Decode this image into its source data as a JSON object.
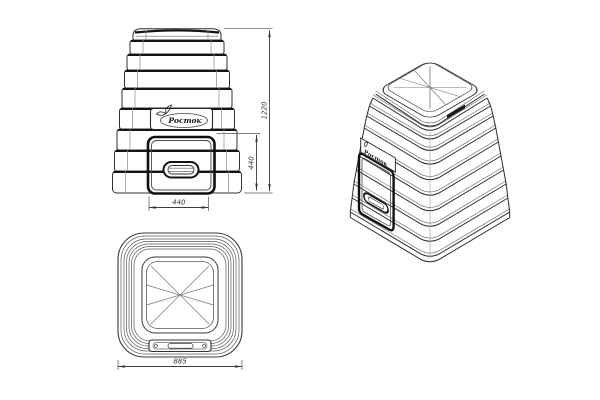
{
  "brand": "Росток",
  "dimensions": {
    "overall_height": "1220",
    "door_height": "440",
    "door_width": "440",
    "base_width": "885"
  },
  "colors": {
    "line": "#2f2f2f",
    "line_dark": "#141414",
    "background": "#ffffff"
  }
}
